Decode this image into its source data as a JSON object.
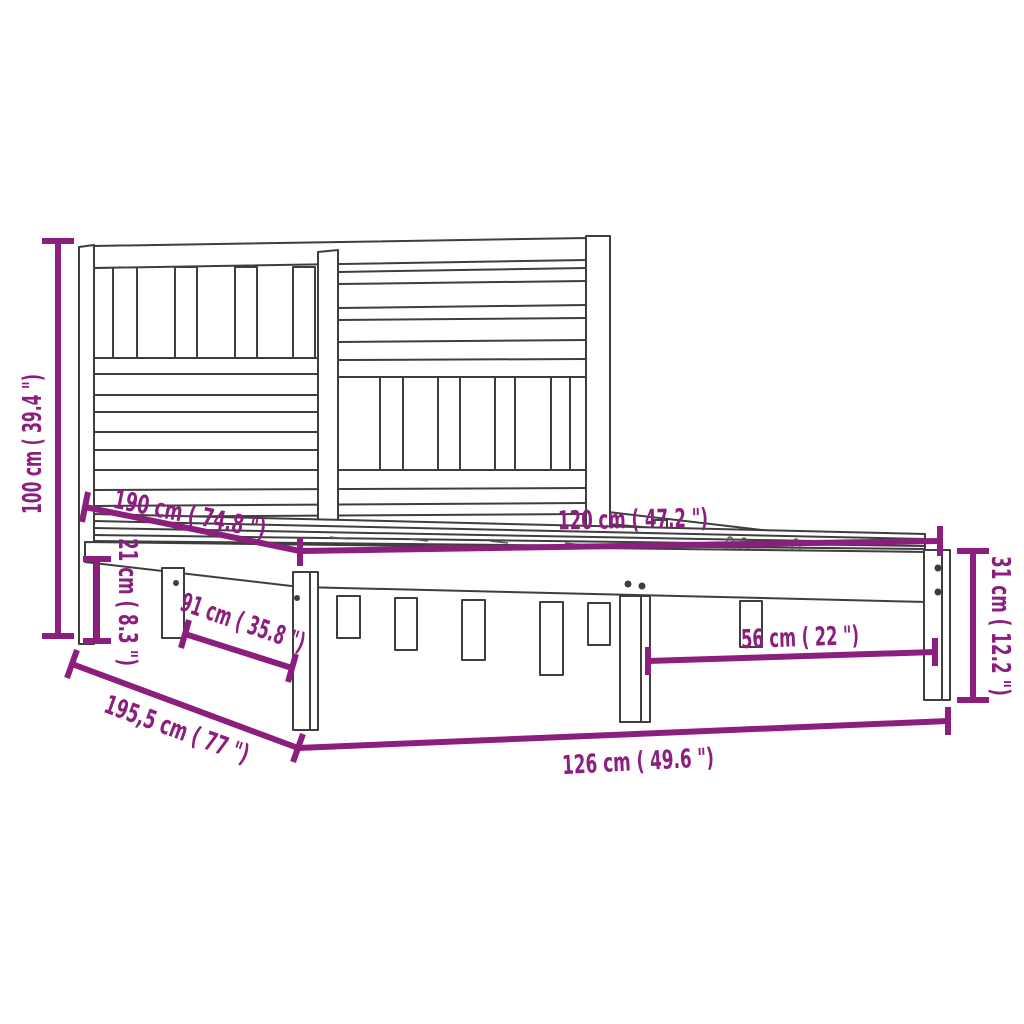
{
  "diagram": {
    "kind": "product-dimension-diagram",
    "subject": "bed-frame-with-slatted-headboard",
    "units": [
      "cm",
      "in"
    ],
    "colors": {
      "accent": "#8C1E7D",
      "line_art": "#3E3E3E",
      "background": "#FFFFFF"
    },
    "dims": {
      "headboard_height": {
        "cm": 100,
        "in": 39.4,
        "label": "100 cm ( 39.4 \")"
      },
      "head_leg_height": {
        "cm": 21,
        "in": 8.3,
        "label": "21 cm ( 8.3 \")"
      },
      "mattress_length": {
        "cm": 190,
        "in": 74.8,
        "label": "190 cm ( 74.8 \")"
      },
      "mattress_width": {
        "cm": 120,
        "in": 47.2,
        "label": "120 cm ( 47.2 \")"
      },
      "foot_frame_height": {
        "cm": 31,
        "in": 12.2,
        "label": "31 cm ( 12.2 \")"
      },
      "foot_leg_spacing": {
        "cm": 56,
        "in": 22,
        "label": "56 cm ( 22 \")"
      },
      "side_leg_spacing": {
        "cm": 91,
        "in": 35.8,
        "label": "91 cm ( 35.8 \")"
      },
      "frame_length": {
        "cm": 195.5,
        "in": 77,
        "label": "195,5 cm ( 77 \")"
      },
      "frame_width": {
        "cm": 126,
        "in": 49.6,
        "label": "126 cm ( 49.6 \")"
      }
    }
  }
}
